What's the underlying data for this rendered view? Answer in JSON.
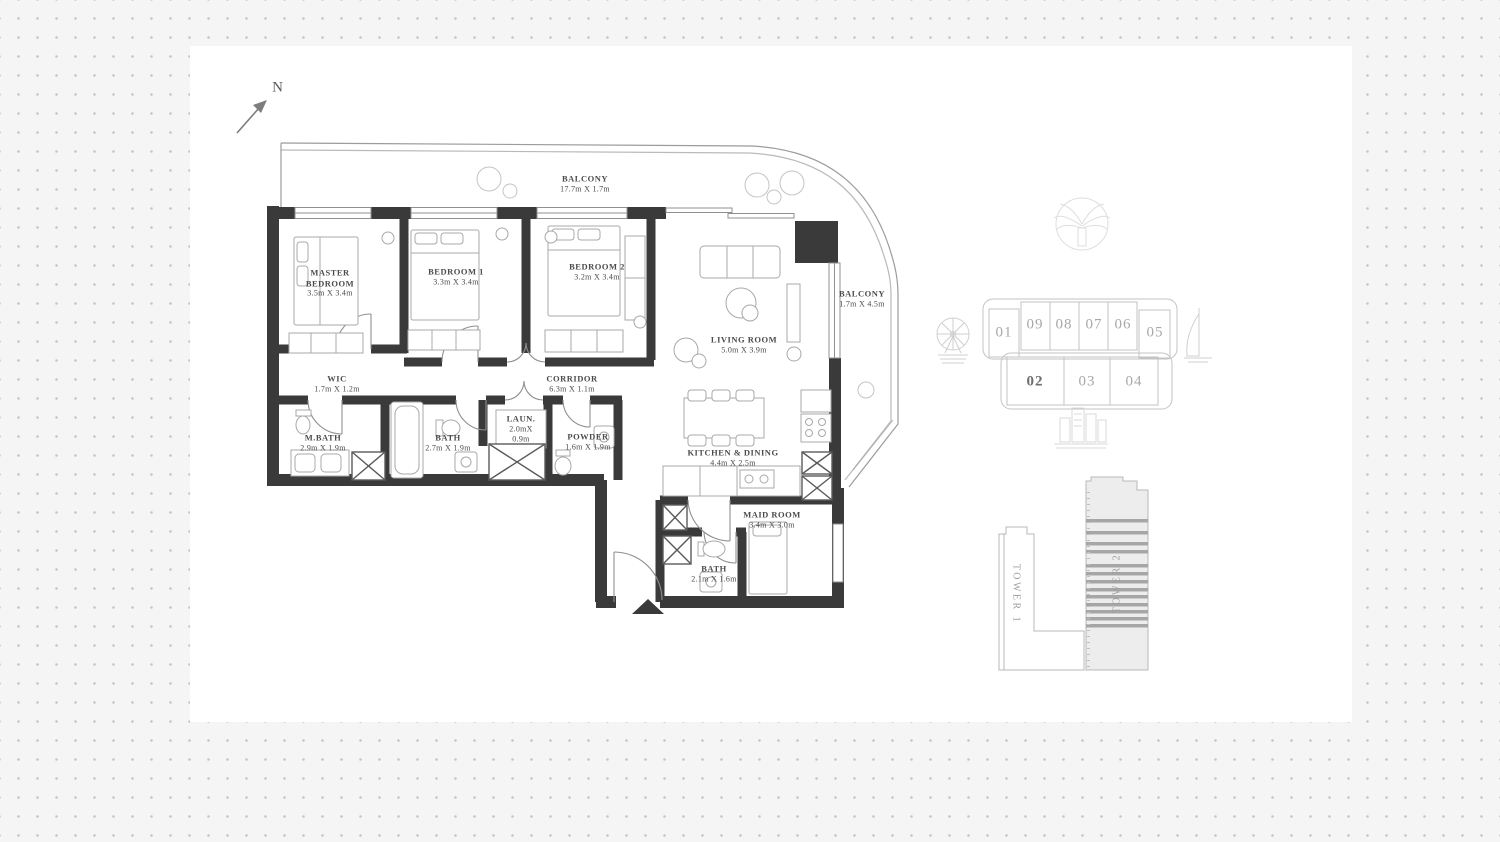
{
  "page": {
    "type": "apartment-floor-plan",
    "compass_label": "N"
  },
  "colors": {
    "wall": "#3a3a3a",
    "thin_line": "#8f8f8f",
    "label_text": "#4b4b4b",
    "key_plan_line": "#c3c3c3",
    "unit_number": "#a8a8a8",
    "unit_number_highlight": "#6e6e6e",
    "tower_stripe": "#a6a6a6",
    "background_dot": "#c6c6c6"
  },
  "floor_plan": {
    "rooms": [
      {
        "id": "balcony-top",
        "name": "BALCONY",
        "dims": "17.7m X 1.7m"
      },
      {
        "id": "master-bedroom",
        "name": "MASTER BEDROOM",
        "dims": "3.5m X 3.4m"
      },
      {
        "id": "bedroom-1",
        "name": "BEDROOM 1",
        "dims": "3.3m X 3.4m"
      },
      {
        "id": "bedroom-2",
        "name": "BEDROOM 2",
        "dims": "3.2m X 3.4m"
      },
      {
        "id": "living-room",
        "name": "LIVING ROOM",
        "dims": "5.0m X 3.9m"
      },
      {
        "id": "balcony-right",
        "name": "BALCONY",
        "dims": "1.7m X 4.5m"
      },
      {
        "id": "wic",
        "name": "WIC",
        "dims": "1.7m X 1.2m"
      },
      {
        "id": "corridor",
        "name": "CORRIDOR",
        "dims": "6.3m X 1.1m"
      },
      {
        "id": "master-bath",
        "name": "M.BATH",
        "dims": "2.9m X 1.9m"
      },
      {
        "id": "bath",
        "name": "BATH",
        "dims": "2.7m X 1.9m"
      },
      {
        "id": "laundry",
        "name": "LAUN.",
        "dims": "2.0mX 0.9m"
      },
      {
        "id": "powder",
        "name": "POWDER",
        "dims": "1.6m X 1.9m"
      },
      {
        "id": "kitchen-dining",
        "name": "KITCHEN & DINING",
        "dims": "4.4m X 2.5m"
      },
      {
        "id": "maid-room",
        "name": "MAID ROOM",
        "dims": "3.4m X 3.0m"
      },
      {
        "id": "maid-bath",
        "name": "BATH",
        "dims": "2.1m X 1.6m"
      }
    ]
  },
  "key_plan": {
    "units": [
      {
        "number": "01",
        "highlighted": false
      },
      {
        "number": "09",
        "highlighted": false
      },
      {
        "number": "08",
        "highlighted": false
      },
      {
        "number": "07",
        "highlighted": false
      },
      {
        "number": "06",
        "highlighted": false
      },
      {
        "number": "05",
        "highlighted": false
      },
      {
        "number": "02",
        "highlighted": true
      },
      {
        "number": "03",
        "highlighted": false
      },
      {
        "number": "04",
        "highlighted": false
      }
    ],
    "highlighted_unit": "02",
    "landmark_icons": [
      "ferris-wheel",
      "palm-island",
      "burj-al-arab",
      "city-skyline"
    ]
  },
  "towers": {
    "tower_1_label": "TOWER 1",
    "tower_2_label": "TOWER 2"
  }
}
